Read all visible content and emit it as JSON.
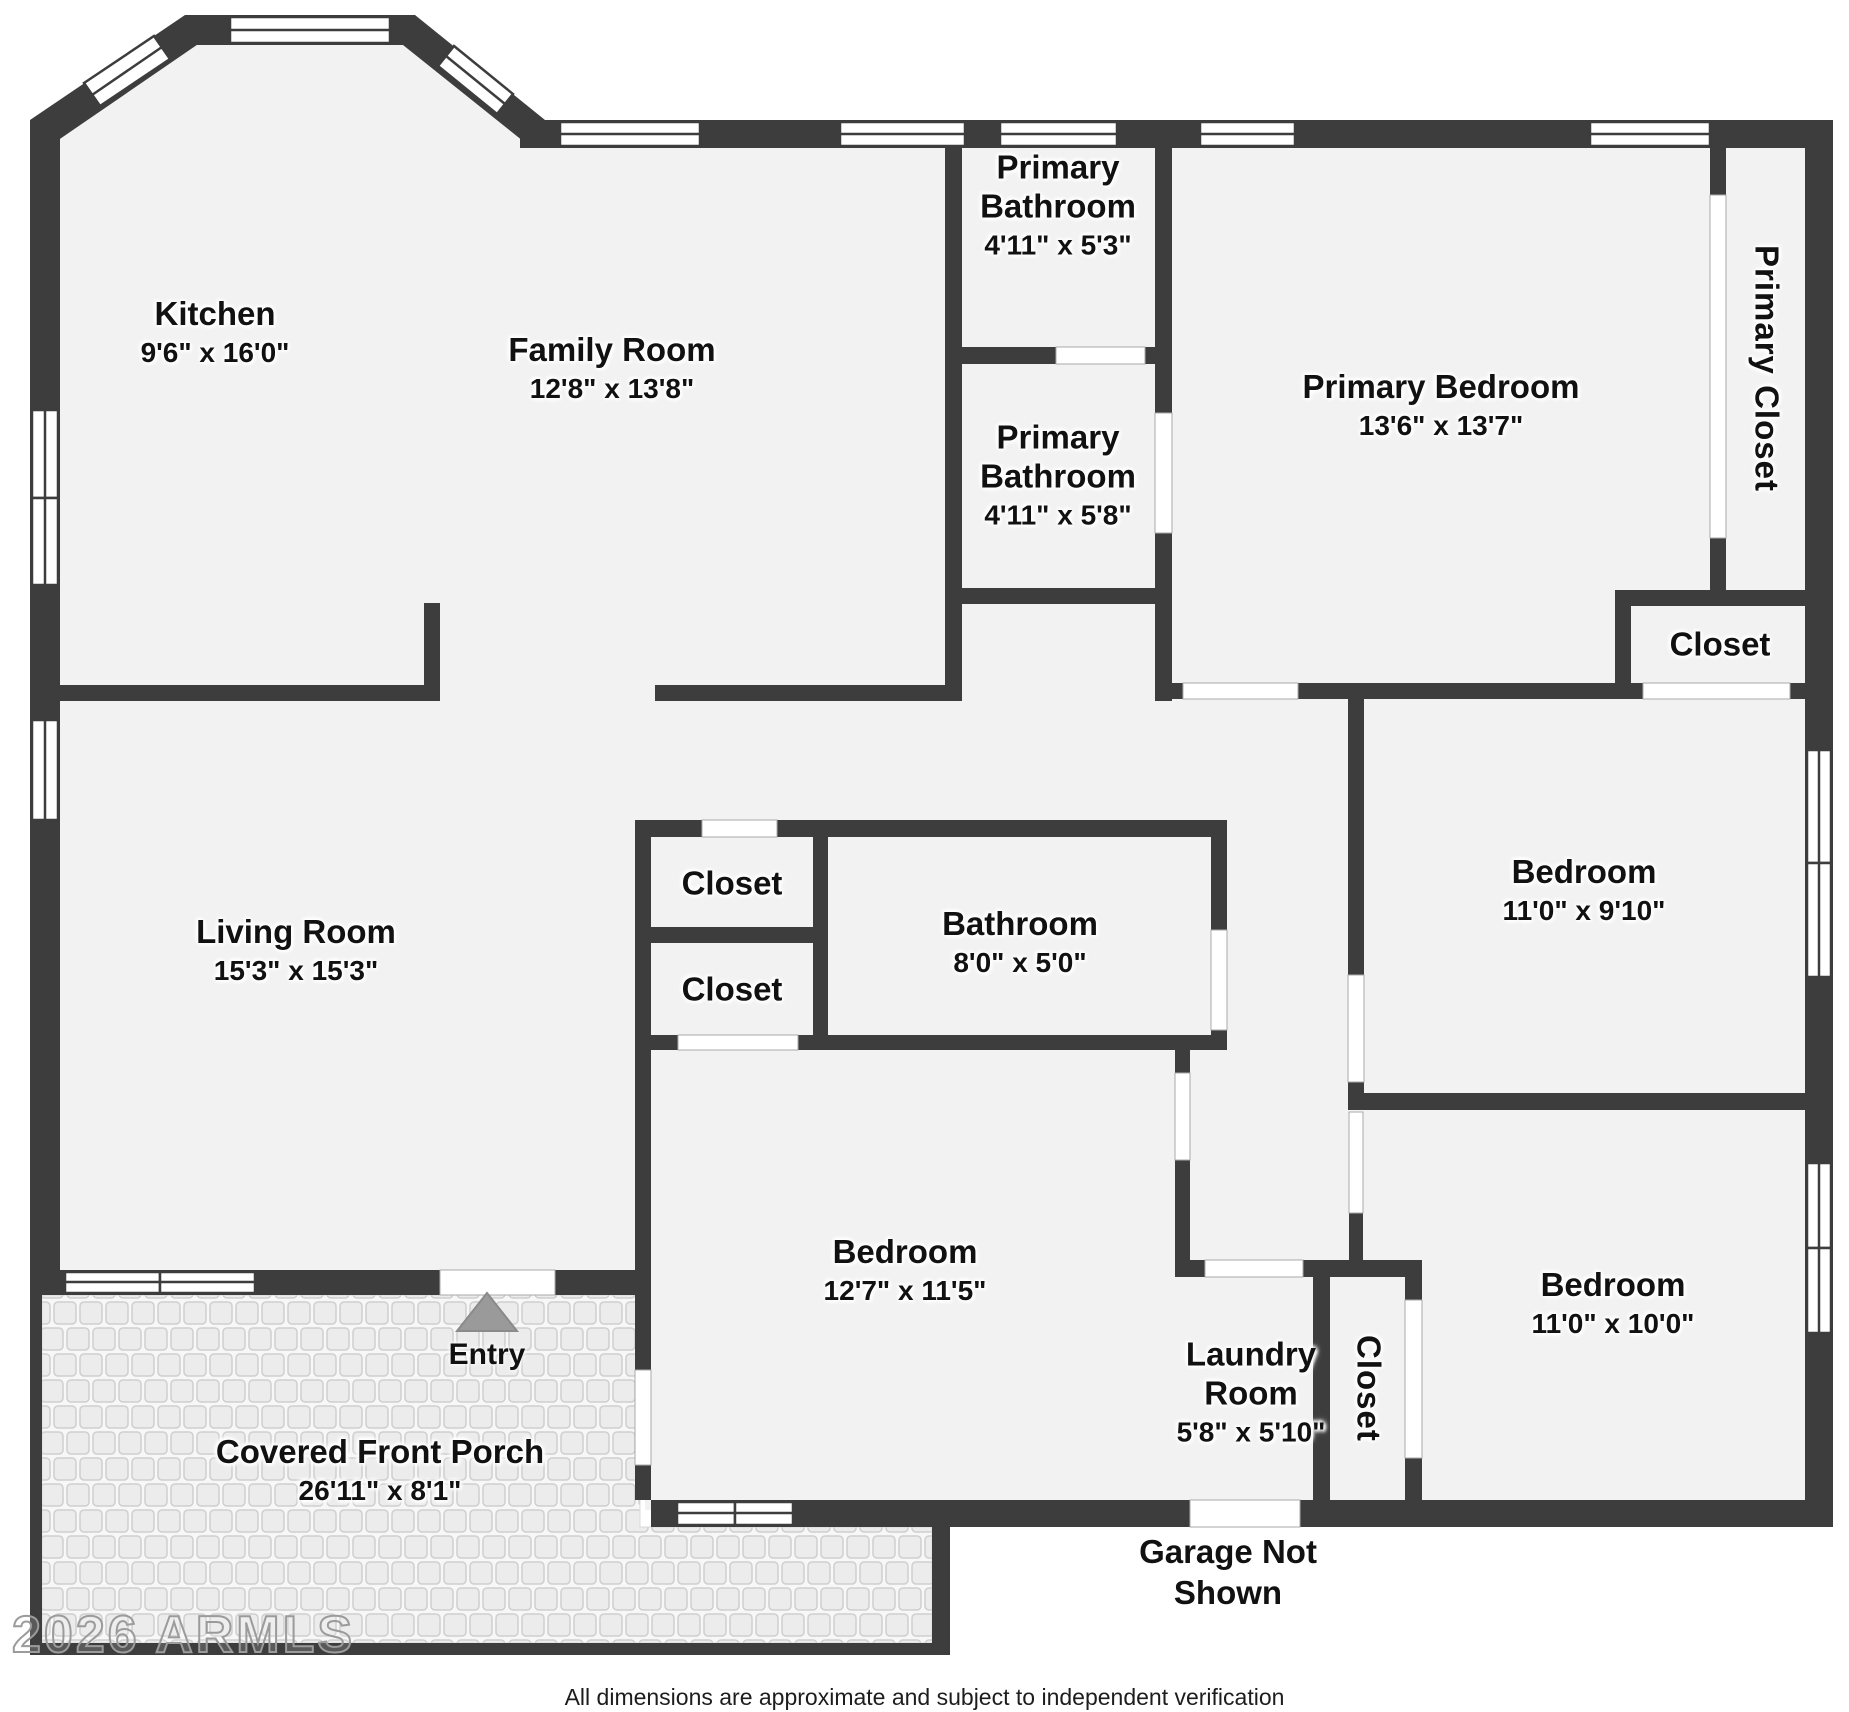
{
  "meta": {
    "type": "residential floor plan",
    "colors": {
      "wall": "#3d3d3d",
      "floor": "#f2f2f2",
      "porch_tile": "#ececec",
      "entry_arrow": "#9a9a9a"
    }
  },
  "rooms": [
    {
      "name": "Kitchen",
      "dims": "9'6\" x 16'0\""
    },
    {
      "name": "Family Room",
      "dims": "12'8\" x 13'8\""
    },
    {
      "name": "Primary Bathroom",
      "dims": "4'11\" x 5'3\""
    },
    {
      "name": "Primary Bathroom",
      "dims": "4'11\" x 5'8\""
    },
    {
      "name": "Primary Bedroom",
      "dims": "13'6\" x 13'7\""
    },
    {
      "name": "Primary Closet",
      "dims": ""
    },
    {
      "name": "Closet",
      "dims": ""
    },
    {
      "name": "Living Room",
      "dims": "15'3\" x 15'3\""
    },
    {
      "name": "Closet",
      "dims": ""
    },
    {
      "name": "Closet",
      "dims": ""
    },
    {
      "name": "Bathroom",
      "dims": "8'0\" x 5'0\""
    },
    {
      "name": "Bedroom",
      "dims": "11'0\" x 9'10\""
    },
    {
      "name": "Bedroom",
      "dims": "12'7\" x 11'5\""
    },
    {
      "name": "Laundry Room",
      "dims": "5'8\" x 5'10\""
    },
    {
      "name": "Closet",
      "dims": ""
    },
    {
      "name": "Bedroom",
      "dims": "11'0\" x 10'0\""
    },
    {
      "name": "Covered Front Porch",
      "dims": "26'11\" x 8'1\""
    }
  ],
  "annotations": {
    "entry": "Entry",
    "garage": "Garage Not Shown",
    "watermark": "2026 ARMLS",
    "footer": "All dimensions are approximate and subject to independent verification"
  }
}
